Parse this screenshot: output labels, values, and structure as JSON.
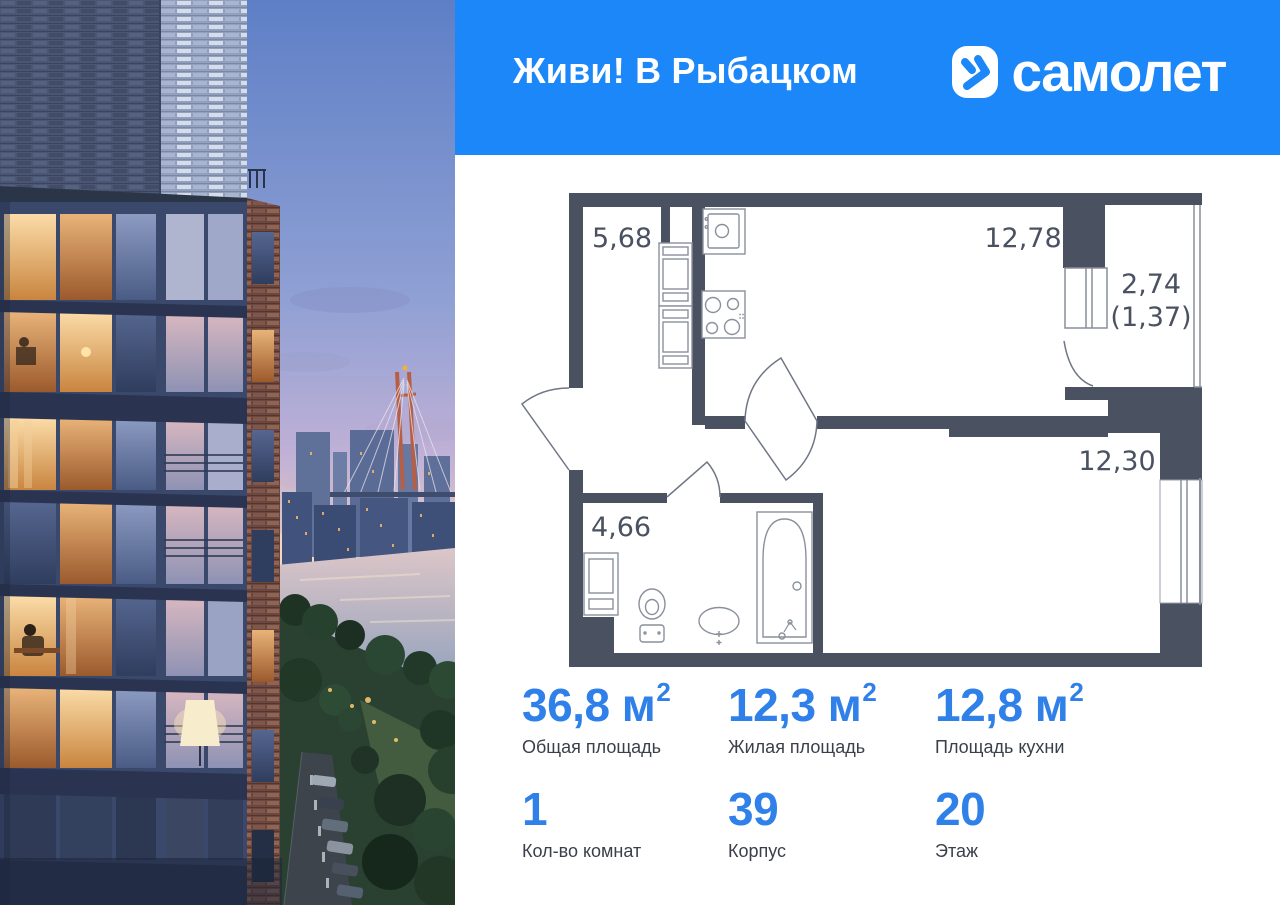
{
  "header": {
    "project_title": "Живи! В Рыбацком",
    "brand_name": "самолет",
    "bg_color": "#1B87F8",
    "logo_icon": "samolet-arrow-icon"
  },
  "floor_plan": {
    "wall_color": "#4A5262",
    "areas": [
      {
        "id": "hallway",
        "value": "5,68"
      },
      {
        "id": "kitchen",
        "value": "12,78"
      },
      {
        "id": "balcony",
        "value": "2,74"
      },
      {
        "id": "balcony-reduced",
        "value": "(1,37)"
      },
      {
        "id": "living-room",
        "value": "12,30"
      },
      {
        "id": "bathroom",
        "value": "4,66"
      }
    ],
    "fixtures": [
      "kitchen-sink-icon",
      "stove-icon",
      "fridge-icon",
      "washing-machine-icon",
      "toilet-icon",
      "washbasin-icon",
      "bathtub-icon"
    ]
  },
  "stats": {
    "accent_color": "#2F80E8",
    "items": [
      {
        "value": "36,8",
        "unit": " м",
        "sup": "2",
        "label": "Общая площадь"
      },
      {
        "value": "12,3",
        "unit": " м",
        "sup": "2",
        "label": "Жилая площадь"
      },
      {
        "value": "12,8",
        "unit": " м",
        "sup": "2",
        "label": "Площадь кухни"
      },
      {
        "value": "1",
        "unit": "",
        "sup": "",
        "label": "Кол-во комнат"
      },
      {
        "value": "39",
        "unit": "",
        "sup": "",
        "label": "Корпус"
      },
      {
        "value": "20",
        "unit": "",
        "sup": "",
        "label": "Этаж"
      }
    ]
  }
}
